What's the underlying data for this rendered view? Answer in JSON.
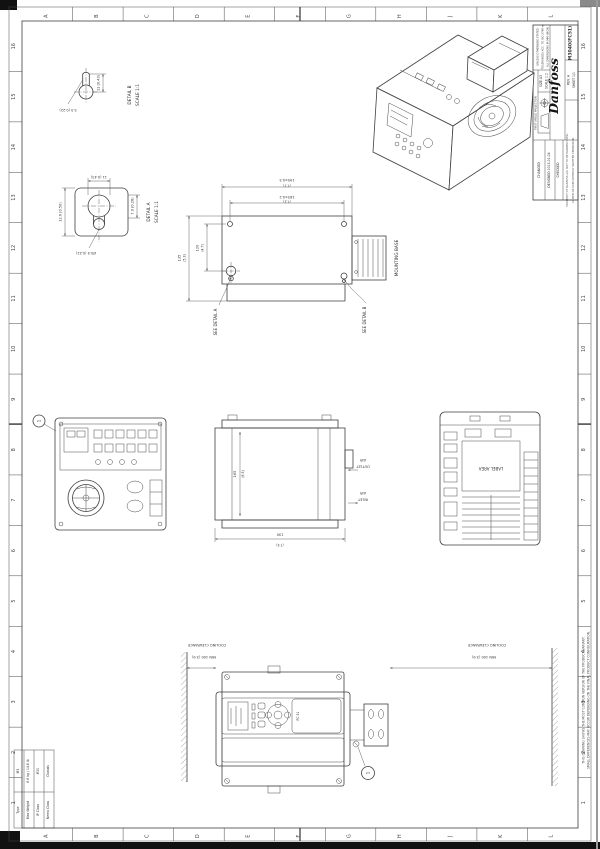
{
  "page": {
    "ink": "#3f3f3f",
    "paper": "#ffffff"
  },
  "sheet": {
    "ruler_letters": [
      "A",
      "B",
      "C",
      "D",
      "E",
      "F",
      "G",
      "H",
      "J",
      "K",
      "L"
    ],
    "ruler_numbers": [
      "16",
      "15",
      "14",
      "13",
      "12",
      "11",
      "10",
      "9",
      "8",
      "7",
      "6",
      "5",
      "4",
      "3",
      "2",
      "1"
    ]
  },
  "title_block": {
    "logo": "Danfoss",
    "drawing_no": "M3040(FC51)",
    "size": "SIZE A3",
    "scale": "SCALE 1:2",
    "projection": "FIRST ANGLE PROJECTION",
    "tol_line1": "UNLESS OTHERWISE STATED",
    "tol_line2": "TOLERANCES ACC. TO ISO 2768-m",
    "tol_line3": "ALL DIMENSIONS IN MM (INCH)",
    "rev": "REV. A",
    "sheet_no": "SHEET 1/1",
    "changed": "CHANGED",
    "designed": "DESIGNED 2013-01-04",
    "checked": "CHECKED",
    "proprietary_1": "PROPERTY OF DANFOSS A/S. NOT TO BE HANDED OVER,",
    "proprietary_2": "COPIED OR USED WITHOUT WRITTEN PERMISSION."
  },
  "edge_note": {
    "line1": "THIS DRAWING SHOWS THE MOST COMMON VERSION OF THE PRODUCT VARIANT.",
    "line2": "SMALL DIFFERENCES MAY OCCUR DEPENDING ON THE FINAL PRODUCT CONFIGURATION."
  },
  "info_table": {
    "rows": [
      {
        "label": "Type",
        "value": "M3"
      },
      {
        "label": "Max Weight",
        "value": "6.6 kg / 14.6 lb"
      },
      {
        "label": "IP Class",
        "value": "IP20"
      },
      {
        "label": "Nema Class",
        "value": "Chassis"
      }
    ]
  },
  "detail_a": {
    "title": "DETAIL A",
    "scale": "SCALE 1:1",
    "dim_left": "12.6 (0.50)",
    "dim_right": "7.0 (0.28)",
    "dim_bottom": "Ø5.5 (0.22)",
    "dim_top": "11 (0.43)"
  },
  "detail_b": {
    "title": "DETAIL B",
    "scale": "SCALE 1:1",
    "dim_right": "11 (0.43)",
    "dim_bottom": "5.5 (0.22)"
  },
  "mounting_view": {
    "dim_top_outer_mm": "195±0.5",
    "dim_top_outer_in": "(7.7)",
    "dim_top_inner_mm": "183±0.2",
    "dim_top_inner_in": "(7.2)",
    "dim_left_outer_mm": "135",
    "dim_left_outer_in": "(5.3)",
    "dim_left_inner_mm": "120",
    "dim_left_inner_in": "(4.7)",
    "mounting_base": "MOUNTING BASE",
    "see_detail_a": "SEE DETAIL A",
    "see_detail_b": "SEE DETAIL B"
  },
  "side_view": {
    "dim_mm": "165",
    "dim_in": "(6.5)",
    "dim_bottom_mm": "190",
    "dim_bottom_in": "(7.5)",
    "air_label": "AIR",
    "outlet": "OUTLET",
    "inlet": "INLET"
  },
  "label_view": {
    "label_area": "LABEL AREA"
  },
  "front_view": {
    "cooling": "COOLING CLEARANCE",
    "min_clearance": "MIN 100 (3.9)",
    "balloon": "1",
    "panel_label": "FC 51"
  }
}
